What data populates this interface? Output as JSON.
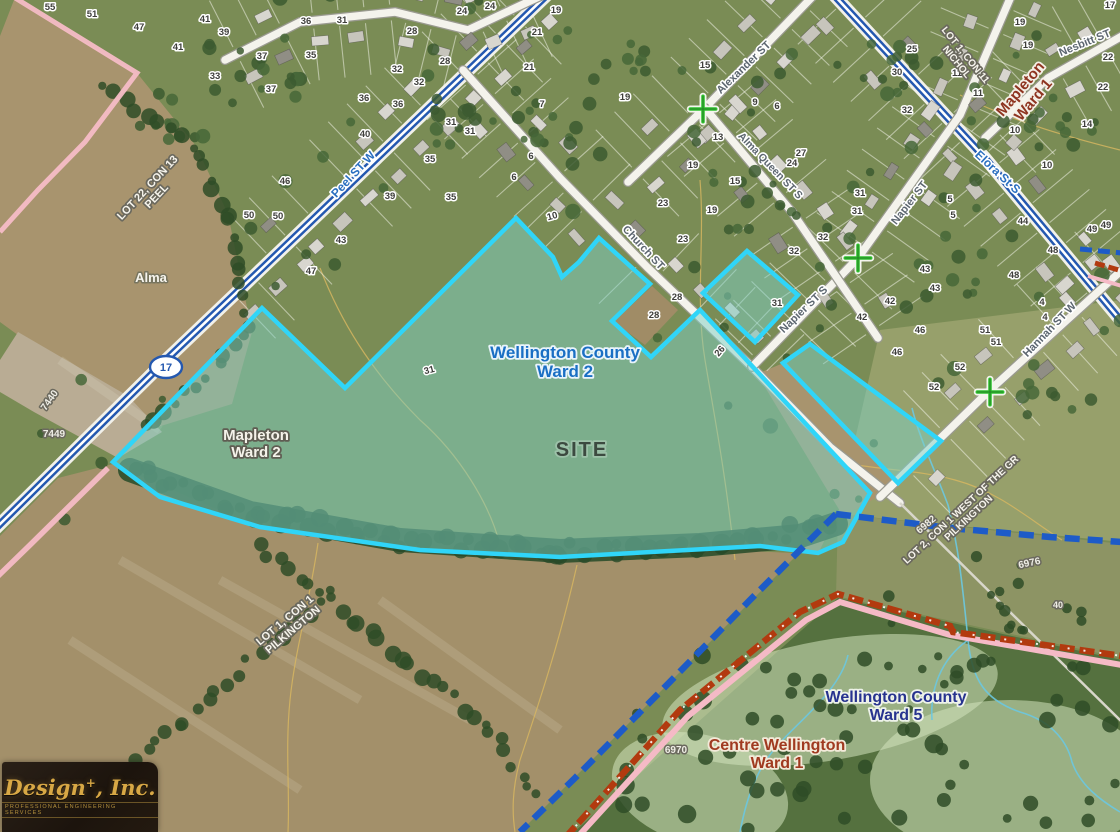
{
  "map": {
    "colors": {
      "site_fill": "#7ed0c4",
      "site_stroke": "#30d5f8",
      "boundary_blue": "#1d5bc8",
      "railway_red": "#b23a0f",
      "railway_pink": "#f5bac6",
      "row_pink": "#f6bcc6",
      "highway_blue": "#2458b0",
      "marker_green": "#2ec22e",
      "contour_tan": "#d9b860",
      "stream_cyan": "#6cc8e0"
    },
    "highway_shield": {
      "text": "17",
      "x": 166,
      "y": 367
    },
    "ward_labels": [
      {
        "id": "wellington-county-ward-2",
        "lines": [
          "Wellington County",
          "Ward 2"
        ],
        "x": 565,
        "y": 358,
        "size": 17,
        "color": "#1a6fc4",
        "rotate": 0,
        "halo": "#e9f4fb"
      },
      {
        "id": "site",
        "lines": [
          "SITE"
        ],
        "x": 582,
        "y": 456,
        "size": 20,
        "color": "#3c4a40",
        "rotate": 0,
        "halo": "rgba(255,255,255,0.25)",
        "ls": 2
      },
      {
        "id": "mapleton-ward-2",
        "lines": [
          "Mapleton",
          "Ward 2"
        ],
        "x": 256,
        "y": 440,
        "size": 15,
        "color": "#f5f3ea",
        "rotate": 0,
        "halo": "#5f5d52"
      },
      {
        "id": "mapleton-ward-1",
        "lines": [
          "Mapleton",
          "Ward 1"
        ],
        "x": 1024,
        "y": 92,
        "size": 15,
        "color": "#8e3420",
        "rotate": -50,
        "halo": "#f4efe6"
      },
      {
        "id": "wellington-county-ward-5",
        "lines": [
          "Wellington County",
          "Ward 5"
        ],
        "x": 896,
        "y": 702,
        "size": 16,
        "color": "#27338f",
        "rotate": 0,
        "halo": "#eef3e9"
      },
      {
        "id": "centre-wellington-ward-1",
        "lines": [
          "Centre Wellington",
          "Ward 1"
        ],
        "x": 777,
        "y": 750,
        "size": 16,
        "color": "#a03a20",
        "rotate": 0,
        "halo": "#f2ead9"
      }
    ],
    "lot_labels": [
      {
        "id": "lot-22-con-13-peel",
        "lines": [
          "LOT 22, CON 13",
          "PEEL"
        ],
        "x": 150,
        "y": 190,
        "rotate": -47,
        "size": 11
      },
      {
        "id": "lot-1-con-11-nichol",
        "lines": [
          "LOT 1, CON 11",
          "NICHOL"
        ],
        "x": 963,
        "y": 57,
        "rotate": 51,
        "size": 10
      },
      {
        "id": "lot-1-con-1-pilkington",
        "lines": [
          "LOT 1, CON 1",
          "PILKINGTON"
        ],
        "x": 287,
        "y": 623,
        "rotate": -40,
        "size": 11
      },
      {
        "id": "lot-2-con-1-pilkington",
        "lines": [
          "LOT 2, CON 1 WEST OF THE GR",
          "PILKINGTON"
        ],
        "x": 963,
        "y": 512,
        "rotate": -43,
        "size": 10
      }
    ],
    "street_labels": [
      {
        "id": "peel-st-w",
        "text": "Peel ST W",
        "x": 356,
        "y": 177,
        "rotate": -47,
        "color": "#2a6fc0",
        "size": 12
      },
      {
        "id": "elora-st-s",
        "text": "Elora St S",
        "x": 995,
        "y": 175,
        "rotate": 43,
        "color": "#2a6fc0",
        "size": 12
      },
      {
        "id": "church-st",
        "text": "Church ST",
        "x": 641,
        "y": 250,
        "rotate": 47,
        "color": "#5c6670",
        "size": 11
      },
      {
        "id": "alexander-st",
        "text": "Alexander ST",
        "x": 746,
        "y": 70,
        "rotate": -44,
        "color": "#5c6670",
        "size": 11
      },
      {
        "id": "alma-queen-st-s",
        "text": "Alma Queen ST S",
        "x": 768,
        "y": 168,
        "rotate": 46,
        "color": "#5c6670",
        "size": 10.5
      },
      {
        "id": "napier-st",
        "text": "Napier ST",
        "x": 912,
        "y": 205,
        "rotate": -52,
        "color": "#5c6670",
        "size": 11
      },
      {
        "id": "napier-st-s",
        "text": "Napier ST S",
        "x": 806,
        "y": 312,
        "rotate": -44,
        "color": "#5c6670",
        "size": 11
      },
      {
        "id": "nesbitt-st",
        "text": "Nesbitt ST",
        "x": 1086,
        "y": 46,
        "rotate": -22,
        "color": "#5c6670",
        "size": 11
      },
      {
        "id": "hannah-st-w",
        "text": "Hannah ST W",
        "x": 1052,
        "y": 332,
        "rotate": -46,
        "color": "#5c6670",
        "size": 11
      }
    ],
    "place_labels": [
      {
        "id": "alma",
        "text": "Alma",
        "x": 151,
        "y": 282,
        "size": 13,
        "color": "#f7f5ee",
        "halo": "#77755f",
        "rotate": 0
      },
      {
        "id": "7440",
        "text": "7440",
        "x": 52,
        "y": 402,
        "size": 10,
        "color": "#efeee6",
        "halo": "#6b695e",
        "rotate": -55
      },
      {
        "id": "7449",
        "text": "7449",
        "x": 54,
        "y": 437,
        "size": 10,
        "color": "#efeee6",
        "halo": "#6b695e",
        "rotate": 0
      },
      {
        "id": "6982",
        "text": "6982",
        "x": 928,
        "y": 527,
        "size": 10,
        "color": "#efeee6",
        "halo": "#6b695e",
        "rotate": -40
      },
      {
        "id": "6976",
        "text": "6976",
        "x": 1030,
        "y": 566,
        "size": 10,
        "color": "#efeee6",
        "halo": "#6b695e",
        "rotate": -12
      },
      {
        "id": "6970",
        "text": "6970",
        "x": 676,
        "y": 753,
        "size": 10,
        "color": "#efeee6",
        "halo": "#6b695e",
        "rotate": 0
      },
      {
        "id": "40-rural",
        "text": "40",
        "x": 1058,
        "y": 608,
        "size": 9,
        "color": "#efeee6",
        "halo": "#6b695e",
        "rotate": 0
      }
    ],
    "house_numbers": [
      [
        50,
        10,
        "55"
      ],
      [
        92,
        17,
        "51"
      ],
      [
        139,
        30,
        "47"
      ],
      [
        205,
        22,
        "41"
      ],
      [
        178,
        50,
        "41"
      ],
      [
        224,
        35,
        "39"
      ],
      [
        215,
        79,
        "33"
      ],
      [
        262,
        59,
        "37"
      ],
      [
        271,
        92,
        "37"
      ],
      [
        306,
        24,
        "36"
      ],
      [
        311,
        58,
        "35"
      ],
      [
        342,
        23,
        "31"
      ],
      [
        412,
        34,
        "28"
      ],
      [
        445,
        64,
        "28"
      ],
      [
        397,
        72,
        "32"
      ],
      [
        419,
        85,
        "32"
      ],
      [
        364,
        101,
        "36"
      ],
      [
        398,
        107,
        "36"
      ],
      [
        365,
        137,
        "40"
      ],
      [
        451,
        125,
        "31"
      ],
      [
        470,
        134,
        "31"
      ],
      [
        430,
        162,
        "35"
      ],
      [
        390,
        199,
        "39"
      ],
      [
        451,
        200,
        "35"
      ],
      [
        462,
        14,
        "24"
      ],
      [
        490,
        9,
        "24"
      ],
      [
        556,
        13,
        "19"
      ],
      [
        537,
        35,
        "21"
      ],
      [
        529,
        70,
        "21"
      ],
      [
        542,
        107,
        "7"
      ],
      [
        531,
        159,
        "6"
      ],
      [
        514,
        180,
        "6"
      ],
      [
        553,
        219,
        "10",
        -15
      ],
      [
        285,
        184,
        "46"
      ],
      [
        249,
        218,
        "50"
      ],
      [
        278,
        219,
        "50"
      ],
      [
        341,
        243,
        "43"
      ],
      [
        311,
        274,
        "47"
      ],
      [
        625,
        100,
        "19"
      ],
      [
        705,
        68,
        "15"
      ],
      [
        755,
        105,
        "9"
      ],
      [
        777,
        109,
        "6"
      ],
      [
        718,
        140,
        "13"
      ],
      [
        693,
        168,
        "19"
      ],
      [
        712,
        213,
        "19"
      ],
      [
        735,
        184,
        "15"
      ],
      [
        663,
        206,
        "23"
      ],
      [
        683,
        242,
        "23"
      ],
      [
        801,
        156,
        "27"
      ],
      [
        792,
        166,
        "24"
      ],
      [
        897,
        75,
        "30"
      ],
      [
        907,
        113,
        "32"
      ],
      [
        912,
        52,
        "25"
      ],
      [
        1020,
        25,
        "19"
      ],
      [
        1028,
        48,
        "19"
      ],
      [
        957,
        76,
        "11"
      ],
      [
        978,
        96,
        "11"
      ],
      [
        1015,
        133,
        "10"
      ],
      [
        1047,
        168,
        "10"
      ],
      [
        1108,
        60,
        "22"
      ],
      [
        1103,
        90,
        "22"
      ],
      [
        1087,
        127,
        "14"
      ],
      [
        1110,
        8,
        "17"
      ],
      [
        860,
        196,
        "31"
      ],
      [
        857,
        214,
        "31"
      ],
      [
        950,
        202,
        "5"
      ],
      [
        953,
        218,
        "5"
      ],
      [
        1023,
        224,
        "44"
      ],
      [
        1092,
        232,
        "49"
      ],
      [
        1106,
        228,
        "49"
      ],
      [
        1053,
        253,
        "48"
      ],
      [
        1014,
        278,
        "48"
      ],
      [
        925,
        272,
        "43"
      ],
      [
        935,
        291,
        "43"
      ],
      [
        890,
        304,
        "42"
      ],
      [
        862,
        320,
        "42"
      ],
      [
        920,
        333,
        "46"
      ],
      [
        897,
        355,
        "46"
      ],
      [
        985,
        333,
        "51"
      ],
      [
        996,
        345,
        "51"
      ],
      [
        1042,
        305,
        "4"
      ],
      [
        1045,
        320,
        "4"
      ],
      [
        960,
        370,
        "52"
      ],
      [
        934,
        390,
        "52"
      ],
      [
        823,
        240,
        "32"
      ],
      [
        794,
        254,
        "32"
      ],
      [
        677,
        300,
        "28"
      ],
      [
        654,
        318,
        "28"
      ],
      [
        722,
        353,
        "26",
        -50
      ],
      [
        777,
        306,
        "31"
      ],
      [
        430,
        373,
        "31",
        -15
      ]
    ],
    "logo": {
      "name": "Design",
      "name_suffix": ", Inc.",
      "sub": "PROFESSIONAL ENGINEERING SERVICES"
    }
  }
}
